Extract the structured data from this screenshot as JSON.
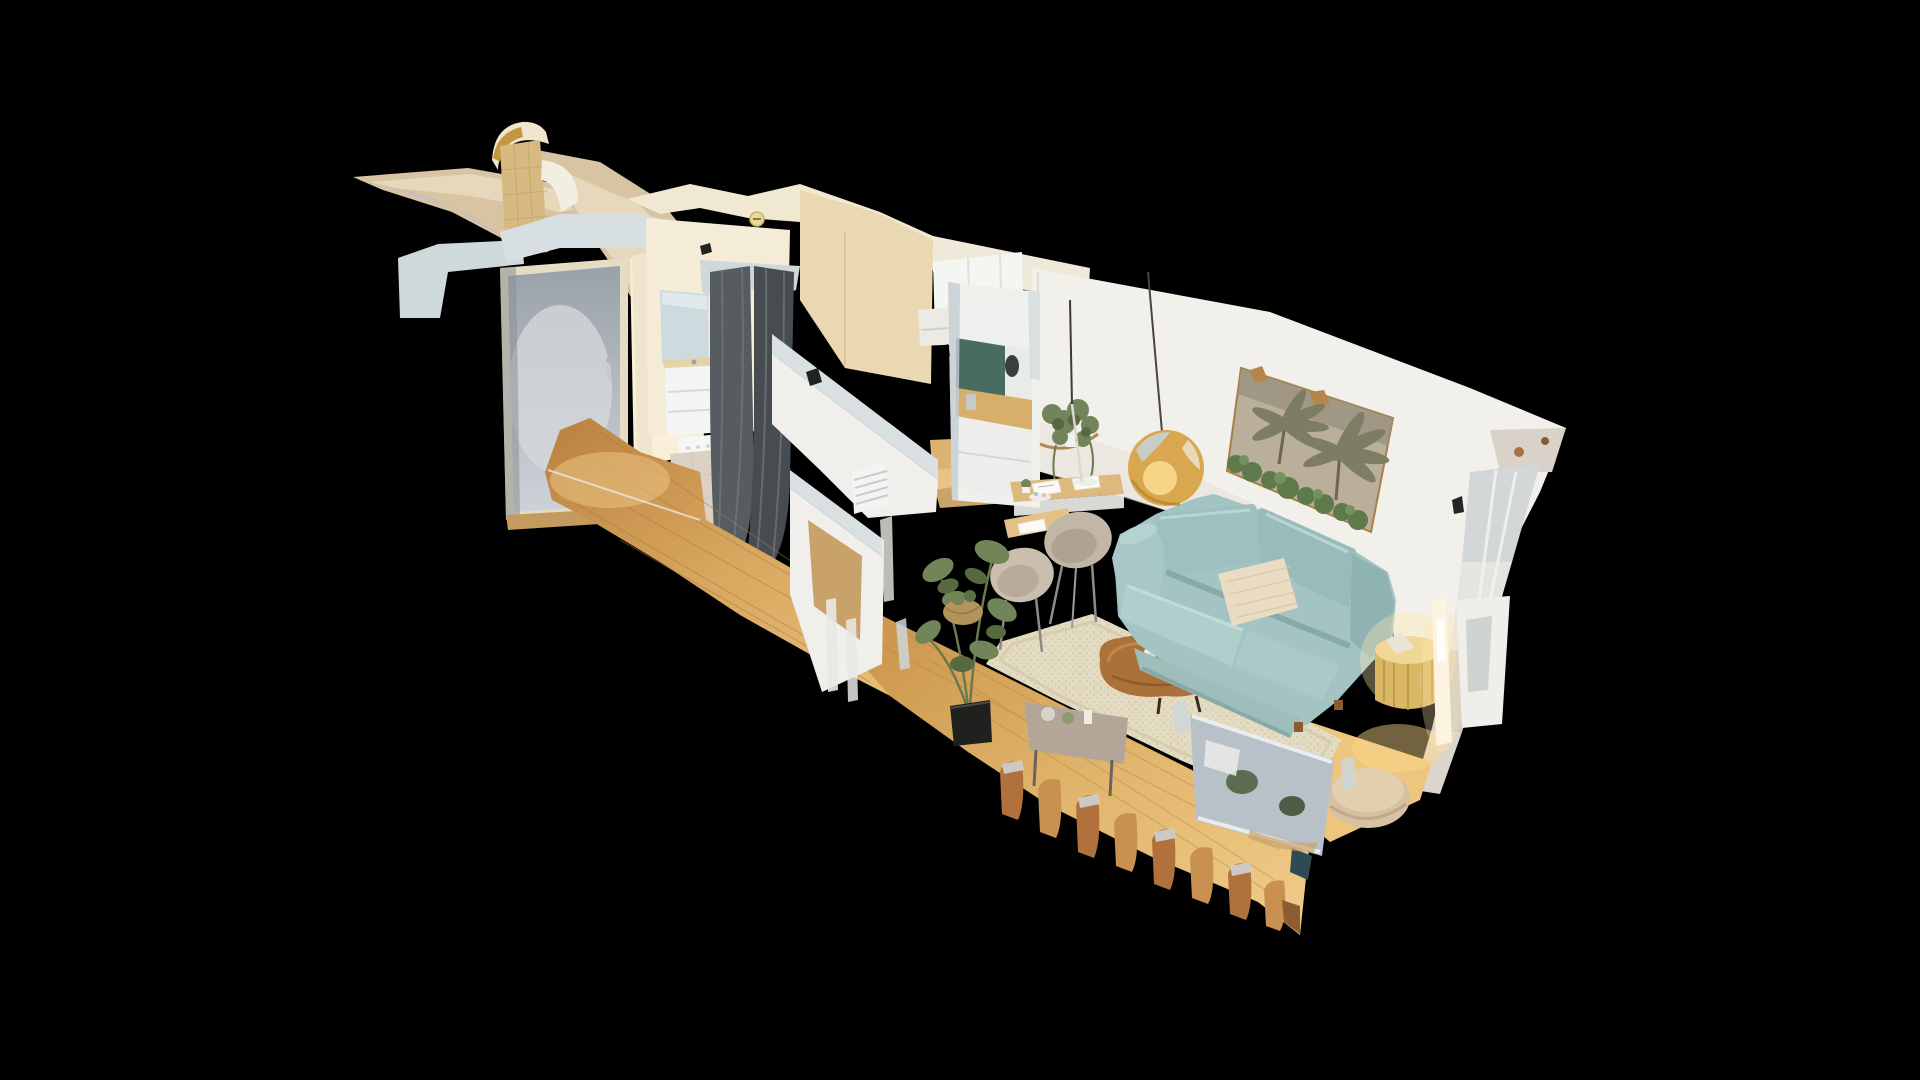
{
  "app": {
    "background": "#000000",
    "viewport_label": "3D dollhouse model view"
  },
  "scene": {
    "view_mode": "dollhouse",
    "objects": [
      "entry-door-frosted-glass",
      "entry-hall-wood-floor",
      "bathroom-mirror",
      "bathroom-vanity",
      "laundry-basket",
      "shower-curtains",
      "kitchen-cabinets",
      "kitchen-backsplash",
      "kitchen-counter-appliances",
      "living-room-wall",
      "kitchen-pass-through-mirror",
      "hanging-plant-shelf",
      "gold-pendant-lamp",
      "palm-tree-artwork",
      "wall-mounted-desk",
      "dining-chairs",
      "monstera-plant",
      "area-rug",
      "wood-coffee-table",
      "teal-sofa",
      "cream-throw-pillow",
      "gold-drum-side-table",
      "glowing-floor-lamp",
      "round-pouf",
      "broken-balcony-railing",
      "fallen-frame-fragment",
      "roof-wing-fragments"
    ]
  },
  "palette": {
    "background": "#000000",
    "wing_beige": "#d8c3a3",
    "wing_beige_light": "#e7d7bb",
    "wing_grey": "#c7c1b7",
    "tower_cream": "#f1e6cb",
    "tower_gold": "#c6953e",
    "tower_tan": "#d7ba82",
    "tower_white": "#f2eee2",
    "cap_grey": "#cfd8db",
    "cap_grey_light": "#d8dfe2",
    "door_frame": "#e4ddc4",
    "entry_wall": "#f7ecd4",
    "bath_wall": "#f5ecd8",
    "mirror_blue": "#cddade",
    "vanity_white": "#f3f5f3",
    "basket_white": "#f6f6f4",
    "tile_floor": "#dbd2c5",
    "curtain_dark": "#474c50",
    "curtain_mid": "#565c60",
    "kitchen_tan": "#ead8b2",
    "cabinet_white": "#f5f5f1",
    "backsplash_green": "#40695d",
    "counter_wood": "#dcb273",
    "partition_white": "#f0efeb",
    "partition_cap": "#d9e0e2",
    "wall_white": "#f2f0ea",
    "wall_shadow": "#e7e3da",
    "mirror_frame": "#eef0ec",
    "mirror_green": "#496c60",
    "mirror_wood": "#d8ae6b",
    "pendant_gold": "#d8a750",
    "pendant_glow": "#f6d488",
    "art_canvas": "#b9af9a",
    "art_palm": "#7d7c64",
    "art_foliage": "#5e7a4a",
    "desk_wood": "#ddb97e",
    "chair_greige": "#c2b6a6",
    "plant_green": "#72855a",
    "plant_dark": "#57693f",
    "pot_black": "#20211f",
    "rug_beige": "#e3dcc2",
    "table_brown": "#aa713a",
    "sofa_teal": "#a3c4c3",
    "sofa_light": "#afcfcc",
    "sofa_dark": "#8fb2b2",
    "sofa_arm": "#a7c8c7",
    "pillow_cream": "#eadcc2",
    "gold_table": "#d9b765",
    "glow_warm": "#ffe9b0",
    "pouf_beige": "#d6c1a2",
    "rail_brown": "#b0713c",
    "rail_light": "#c8914f",
    "fragment_silver": "#b9c1c8",
    "console_grey": "#b3a698"
  }
}
